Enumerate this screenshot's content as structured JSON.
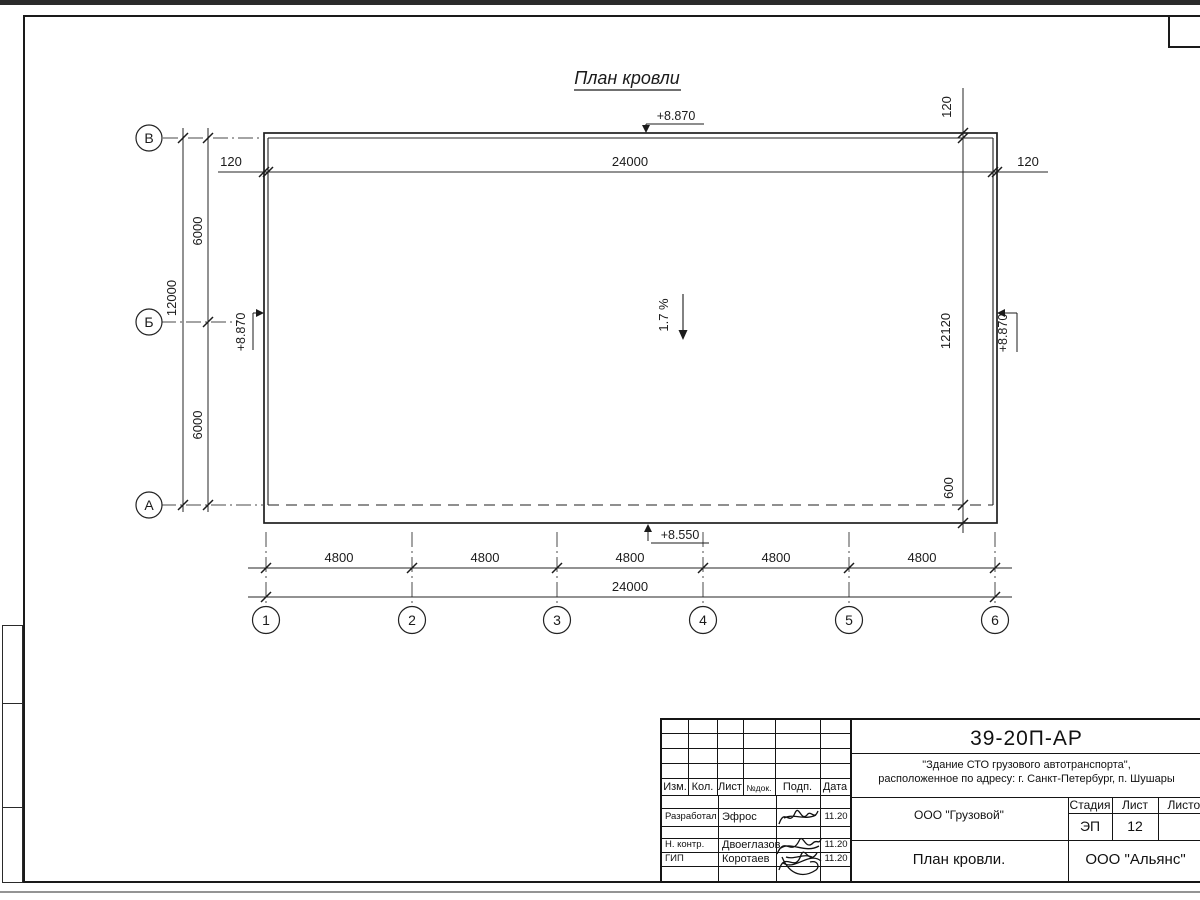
{
  "drawing": {
    "title": "План кровли",
    "slope_label": "1.7 %",
    "row_axes": [
      "В",
      "Б",
      "А"
    ],
    "col_axes": [
      "1",
      "2",
      "3",
      "4",
      "5",
      "6"
    ],
    "dims": {
      "total_width": "24000",
      "bay": "4800",
      "edge_offset": "120",
      "total_height": "12000",
      "row_bay": "6000",
      "right_height": "12120",
      "eave_drop": "600"
    },
    "elevations": {
      "parapet": "+8.870",
      "eave": "+8.550"
    }
  },
  "title_block": {
    "doc_code": "39-20П-АР",
    "project_line1": "\"Здание СТО грузового автотранспорта\",",
    "project_line2": "расположенное по адресу: г. Санкт-Петербург, п. Шушары",
    "header_cols": [
      "Изм.",
      "Кол.",
      "Лист",
      "№док.",
      "Подп.",
      "Дата"
    ],
    "rows": [
      {
        "role": "Разработал",
        "name": "Эфрос",
        "date": "11.20"
      },
      {
        "role": "Н. контр.",
        "name": "Двоеглазов",
        "date": "11.20"
      },
      {
        "role": "ГИП",
        "name": "Коротаев",
        "date": "11.20"
      }
    ],
    "customer_org": "ООО \"Грузовой\"",
    "sheet_name": "План кровли.",
    "designer_org": "ООО \"Альянс\"",
    "stage_label": "Стадия",
    "sheet_label": "Лист",
    "sheets_label": "Листов",
    "stage_value": "ЭП",
    "sheet_value": "12"
  }
}
